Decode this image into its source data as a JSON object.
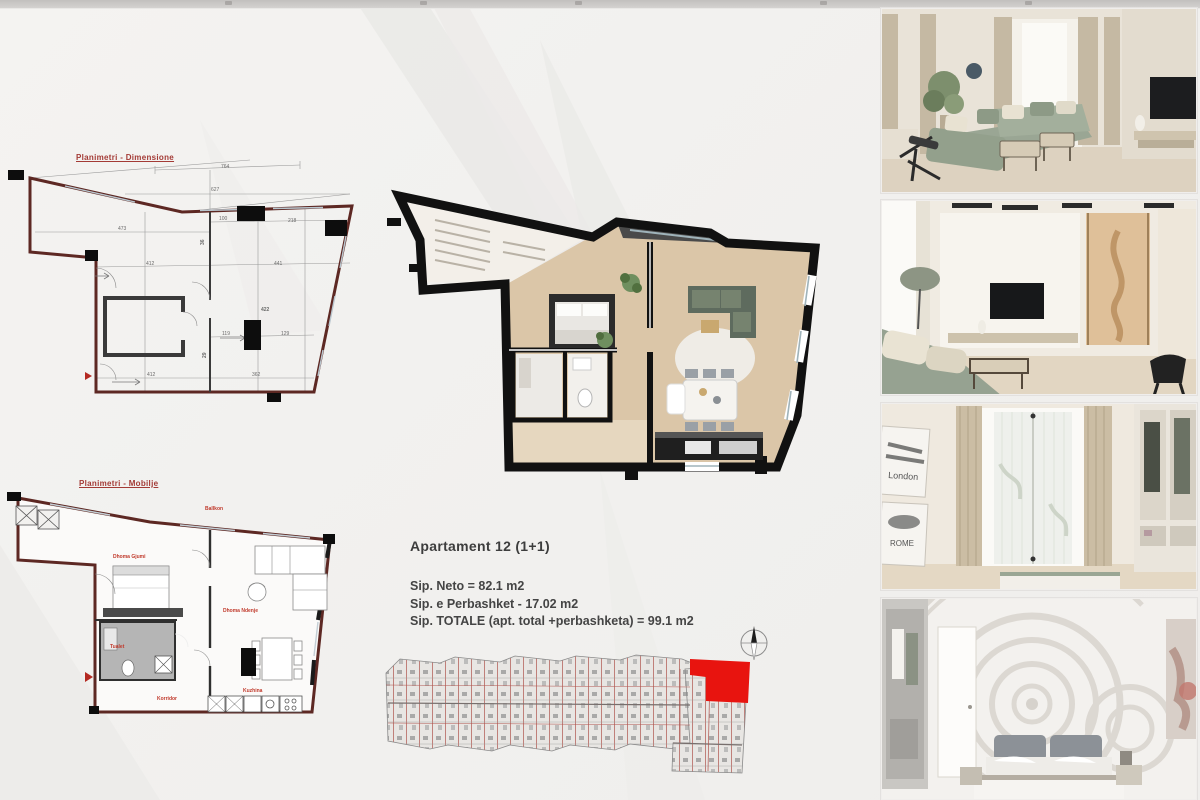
{
  "document": {
    "info": {
      "title": "Apartament 12 (1+1)",
      "area_net": "Sip. Neto = 82.1 m2",
      "area_common": "Sip. e Perbashket - 17.02 m2",
      "area_total": "Sip. TOTALE (apt. total +perbashketa) = 99.1 m2"
    },
    "plans": {
      "dimension_plan": {
        "title": "Planimetri - Dimensione",
        "dims": [
          "764",
          "627",
          "473",
          "100",
          "218",
          "412",
          "441",
          "422",
          "119",
          "129",
          "362",
          "36",
          "29"
        ]
      },
      "furniture_plan": {
        "title": "Planimetri - Mobilje",
        "labels": {
          "balcony": "Ballkon",
          "bedroom": "Dhoma Gjumi",
          "living_room": "Dhoma Ndenje",
          "toilet": "Tualet",
          "corridor": "Korridor",
          "kitchen": "Kuzhina"
        }
      }
    },
    "key_plan": {
      "highlight_color": "#e8140f"
    },
    "renders": {
      "wall_art": {
        "left": "London",
        "right": "ROME"
      }
    },
    "colors": {
      "plan_wall": "#5d2823",
      "plan_title_red": "#a33a35",
      "label_red": "#c0392b",
      "highlight_red": "#e8140f",
      "sofa_green": "#9aa694",
      "wood_floor": "#dbc6a8"
    }
  }
}
